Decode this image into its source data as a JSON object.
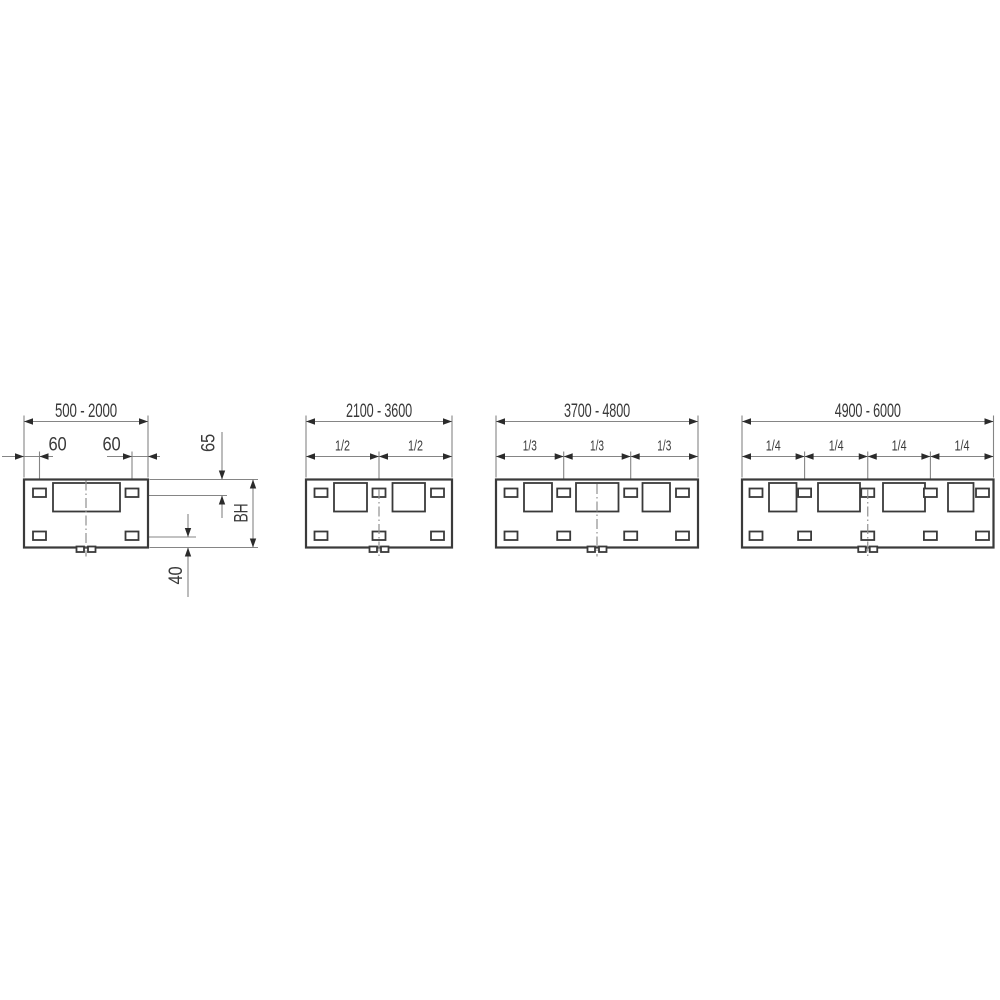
{
  "panels": [
    {
      "range_label": "500 - 2000",
      "left_offset_label": "60",
      "right_offset_label": "60",
      "top_hole_offset_label": "65",
      "height_label": "BH",
      "bottom_hole_offset_label": "40"
    },
    {
      "range_label": "2100 - 3600",
      "fraction_labels": [
        "1/2",
        "1/2"
      ]
    },
    {
      "range_label": "3700 - 4800",
      "fraction_labels": [
        "1/3",
        "1/3",
        "1/3"
      ]
    },
    {
      "range_label": "4900 - 6000",
      "fraction_labels": [
        "1/4",
        "1/4",
        "1/4",
        "1/4"
      ]
    }
  ],
  "colors": {
    "outline": "#3a3a3a",
    "dimension_line": "#858585",
    "arrowhead": "#2b2b2b",
    "text": "#3a3a3a",
    "centerline": "#8f8f8f",
    "background": "#ffffff"
  }
}
